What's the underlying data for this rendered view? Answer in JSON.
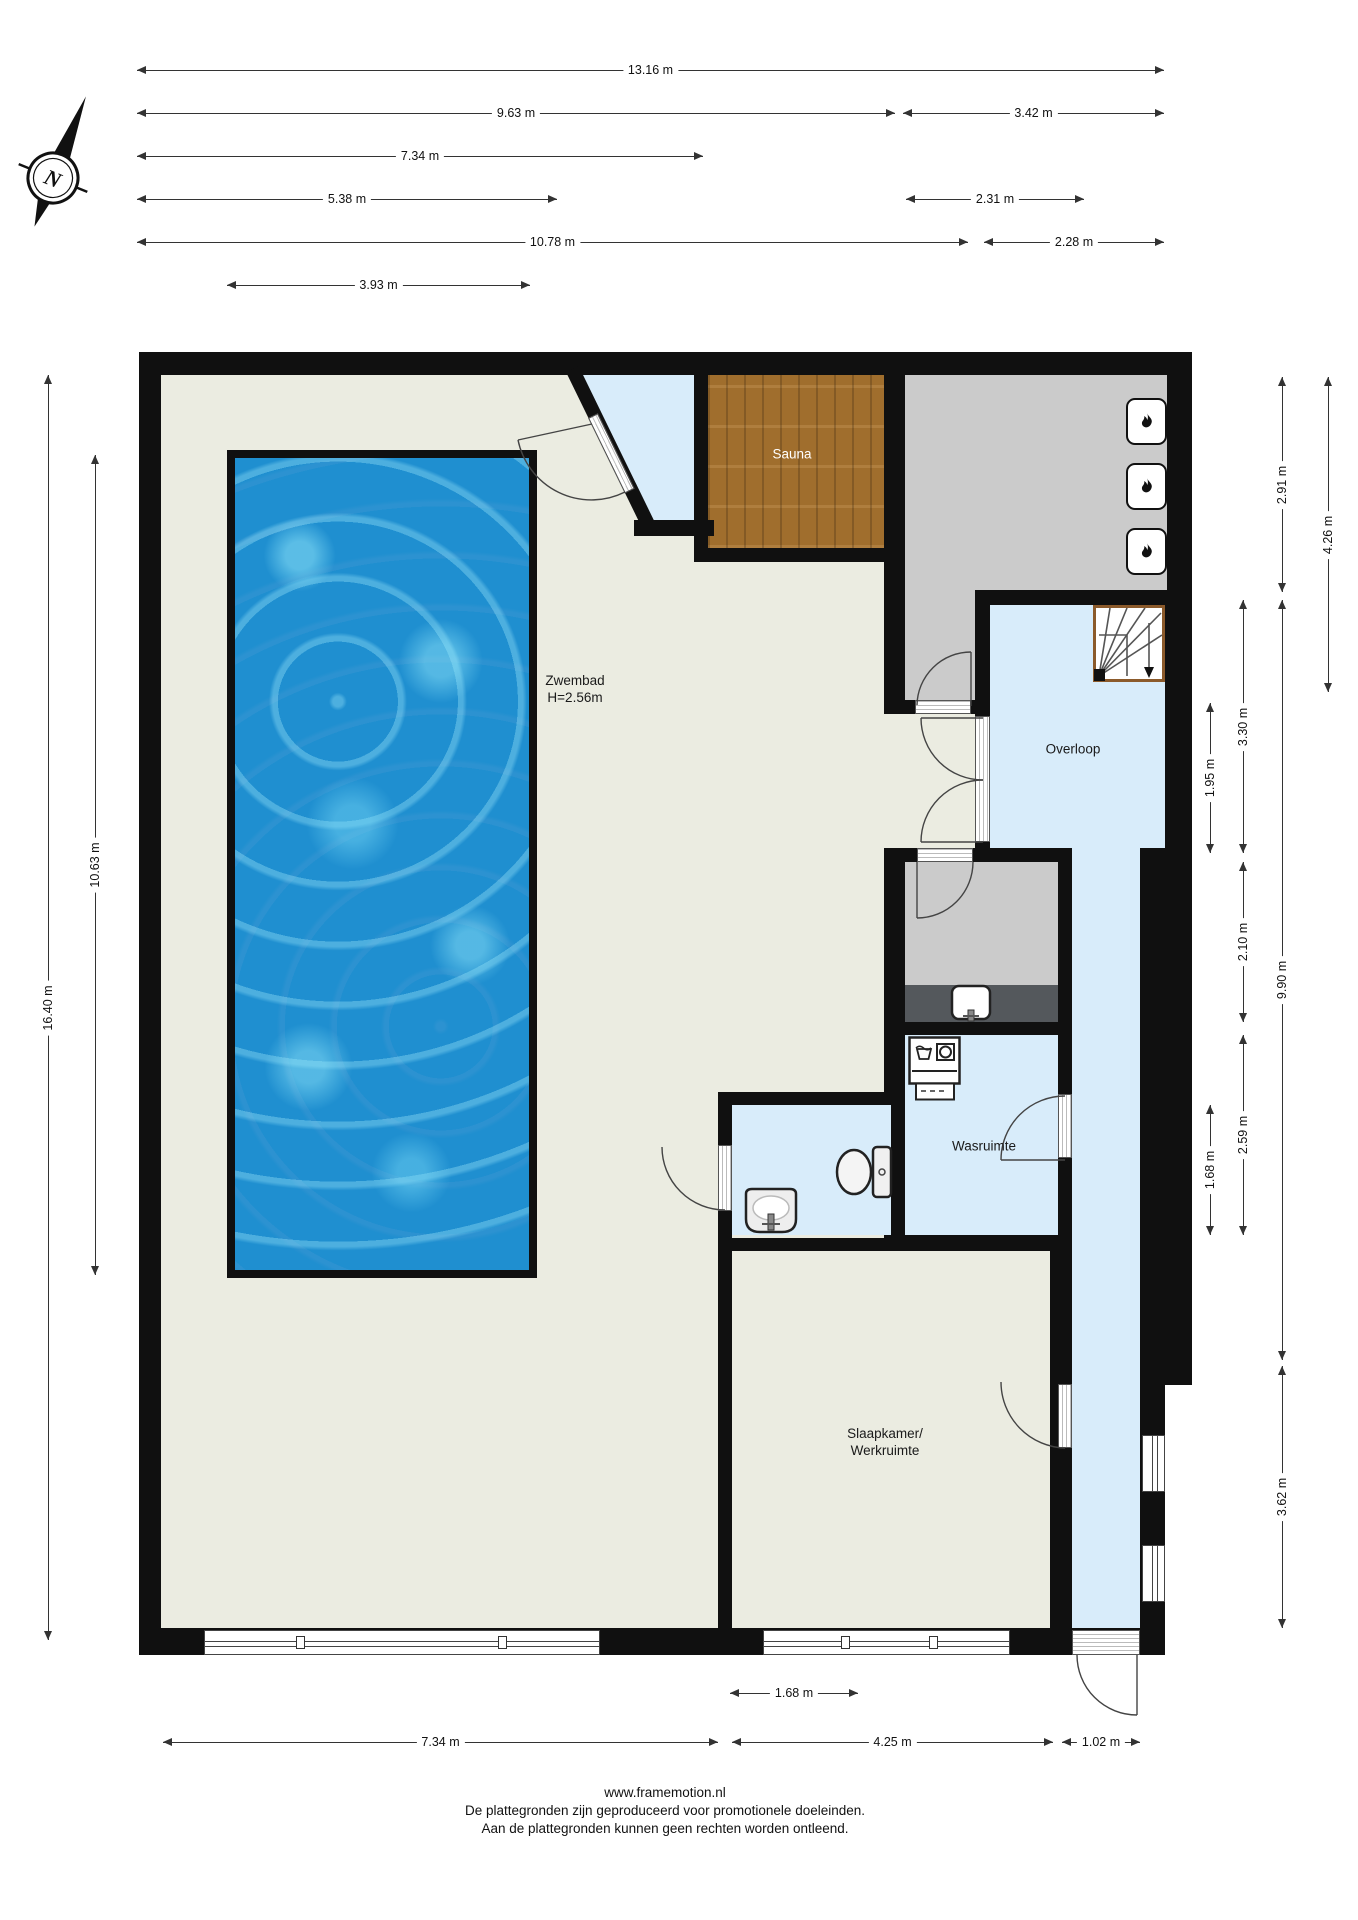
{
  "compass": {
    "label": "N"
  },
  "rooms": {
    "zwembad": {
      "label": "Zwembad",
      "sublabel": "H=2.56m"
    },
    "sauna": {
      "label": "Sauna"
    },
    "overloop": {
      "label": "Overloop"
    },
    "wasruimte": {
      "label": "Wasruimte"
    },
    "slaapkamer": {
      "label": "Slaapkamer/",
      "label2": "Werkruimte"
    }
  },
  "dimensions": [
    {
      "label": "13.16 m",
      "orient": "h",
      "from": 137,
      "to": 1164,
      "at": 70
    },
    {
      "label": "9.63 m",
      "orient": "h",
      "from": 137,
      "to": 895,
      "at": 113
    },
    {
      "label": "3.42 m",
      "orient": "h",
      "from": 903,
      "to": 1164,
      "at": 113
    },
    {
      "label": "7.34 m",
      "orient": "h",
      "from": 137,
      "to": 703,
      "at": 156
    },
    {
      "label": "5.38 m",
      "orient": "h",
      "from": 137,
      "to": 557,
      "at": 199
    },
    {
      "label": "2.31 m",
      "orient": "h",
      "from": 906,
      "to": 1084,
      "at": 199
    },
    {
      "label": "10.78 m",
      "orient": "h",
      "from": 137,
      "to": 968,
      "at": 242
    },
    {
      "label": "2.28 m",
      "orient": "h",
      "from": 984,
      "to": 1164,
      "at": 242
    },
    {
      "label": "3.93 m",
      "orient": "h",
      "from": 227,
      "to": 530,
      "at": 285
    },
    {
      "label": "16.40 m",
      "orient": "v",
      "from": 375,
      "to": 1640,
      "at": 48
    },
    {
      "label": "10.63 m",
      "orient": "v",
      "from": 455,
      "to": 1275,
      "at": 95
    },
    {
      "label": "2.91 m",
      "orient": "v",
      "from": 377,
      "to": 592,
      "at": 1282
    },
    {
      "label": "4.26 m",
      "orient": "v",
      "from": 377,
      "to": 692,
      "at": 1328
    },
    {
      "label": "3.30 m",
      "orient": "v",
      "from": 600,
      "to": 853,
      "at": 1243
    },
    {
      "label": "1.95 m",
      "orient": "v",
      "from": 703,
      "to": 853,
      "at": 1210
    },
    {
      "label": "2.10 m",
      "orient": "v",
      "from": 862,
      "to": 1022,
      "at": 1243
    },
    {
      "label": "9.90 m",
      "orient": "v",
      "from": 600,
      "to": 1360,
      "at": 1282
    },
    {
      "label": "2.59 m",
      "orient": "v",
      "from": 1035,
      "to": 1235,
      "at": 1243
    },
    {
      "label": "1.68 m",
      "orient": "v",
      "from": 1105,
      "to": 1235,
      "at": 1210
    },
    {
      "label": "3.62 m",
      "orient": "v",
      "from": 1366,
      "to": 1628,
      "at": 1282
    },
    {
      "label": "1.68 m",
      "orient": "h",
      "from": 730,
      "to": 858,
      "at": 1693
    },
    {
      "label": "7.34 m",
      "orient": "h",
      "from": 163,
      "to": 718,
      "at": 1742
    },
    {
      "label": "4.25 m",
      "orient": "h",
      "from": 732,
      "to": 1053,
      "at": 1742
    },
    {
      "label": "1.02 m",
      "orient": "h",
      "from": 1062,
      "to": 1140,
      "at": 1742
    }
  ],
  "footer": {
    "url": "www.framemotion.nl",
    "line1": "De plattegronden zijn geproduceerd voor promotionele doeleinden.",
    "line2": "Aan de plattegronden kunnen geen rechten worden ontleend."
  },
  "colors": {
    "wall": "#101010",
    "floor": "#ebece1",
    "wet": "#d8ecfa",
    "gray": "#cbcbcb",
    "counter": "#54585c",
    "wood": "#a9742f",
    "pool": "#1f8fd0"
  }
}
